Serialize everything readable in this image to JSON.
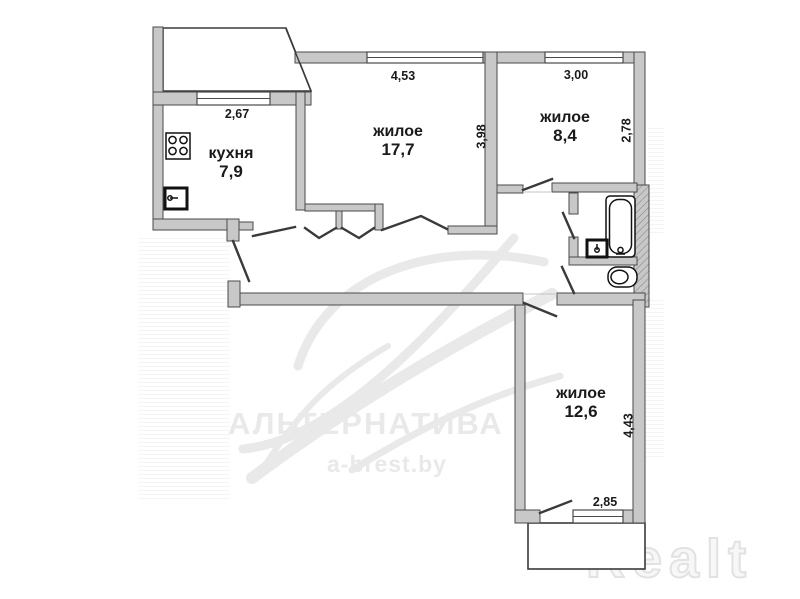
{
  "plan_title": "3-room apartment floor plan",
  "rooms": [
    {
      "label": "кухня",
      "area": "7,9"
    },
    {
      "label": "жилое",
      "area": "17,7"
    },
    {
      "label": "жилое",
      "area": "8,4"
    },
    {
      "label": "жилое",
      "area": "12,6"
    }
  ],
  "dimensions": [
    {
      "id": "kitchen-width",
      "value": "2,67"
    },
    {
      "id": "living1-width",
      "value": "4,53"
    },
    {
      "id": "living1-depth",
      "value": "3,98"
    },
    {
      "id": "living2-width",
      "value": "3,00"
    },
    {
      "id": "living2-depth",
      "value": "2,78"
    },
    {
      "id": "living3-depth",
      "value": "4,43"
    },
    {
      "id": "living3-width",
      "value": "2,85"
    }
  ],
  "watermark": {
    "brand": "АЛЬТЕРНАТИВА",
    "site": "a-brest.by",
    "logo": "Realt"
  },
  "colors": {
    "wall_fill": "#c8c8c8",
    "wall_edge": "#4a4a4a",
    "line": "#3a3a3a",
    "fixture": "#111111",
    "text": "#1a1a1a",
    "wm_gray": "#e9e9e9"
  }
}
